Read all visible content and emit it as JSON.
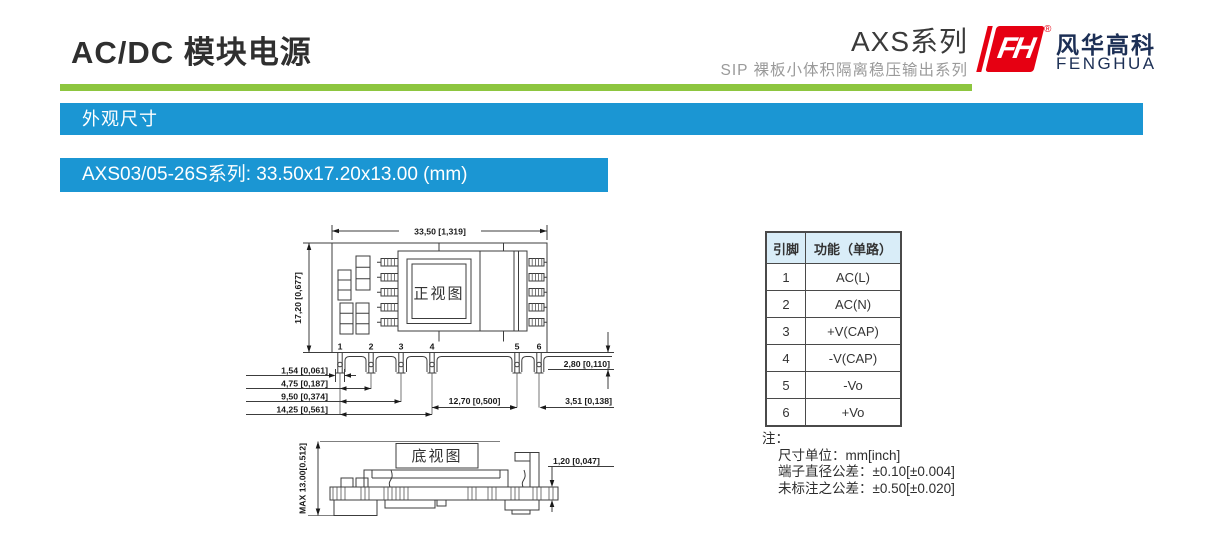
{
  "header": {
    "title": "AC/DC 模块电源",
    "series_title": "AXS系列",
    "series_subtitle": "SIP 裸板小体积隔离稳压输出系列",
    "logo": {
      "cn": "风华高科",
      "en": "FENGHUA",
      "fh": "FH",
      "registered": "®"
    }
  },
  "banners": {
    "section": "外观尺寸",
    "model": "AXS03/05-26S系列: 33.50x17.20x13.00 (mm)"
  },
  "front_view": {
    "label": "正视图",
    "dims": {
      "width": "33,50 [1,319]",
      "height": "17,20 [0,677]",
      "pin_offset": "1,54 [0,061]",
      "pitch1": "4,75 [0,187]",
      "pitch2": "9,50 [0,374]",
      "pitch3": "14,25 [0,561]",
      "gap45": "12,70 [0,500]",
      "pin_length": "2,80 [0,110]",
      "pitch56": "3,51 [0,138]"
    },
    "pins": [
      "1",
      "2",
      "3",
      "4",
      "5",
      "6"
    ]
  },
  "bottom_view": {
    "label": "底视图",
    "dims": {
      "max_height": "MAX 13.00[0.512]",
      "board_thickness": "1,20 [0,047]"
    }
  },
  "pin_table": {
    "headers": [
      "引脚",
      "功能（单路）"
    ],
    "rows": [
      {
        "pin": "1",
        "func": "AC(L)"
      },
      {
        "pin": "2",
        "func": "AC(N)"
      },
      {
        "pin": "3",
        "func": "+V(CAP)"
      },
      {
        "pin": "4",
        "func": "-V(CAP)"
      },
      {
        "pin": "5",
        "func": "-Vo"
      },
      {
        "pin": "6",
        "func": "+Vo"
      }
    ]
  },
  "notes": {
    "title": "注：",
    "lines": [
      "尺寸单位：mm[inch]",
      "端子直径公差：±0.10[±0.004]",
      "未标注之公差：±0.50[±0.020]"
    ]
  },
  "colors": {
    "accent_blue": "#1b96d3",
    "accent_green": "#8dc63f",
    "logo_red": "#e60012",
    "logo_navy": "#1c2f55",
    "table_header_bg": "#d9edf8"
  }
}
